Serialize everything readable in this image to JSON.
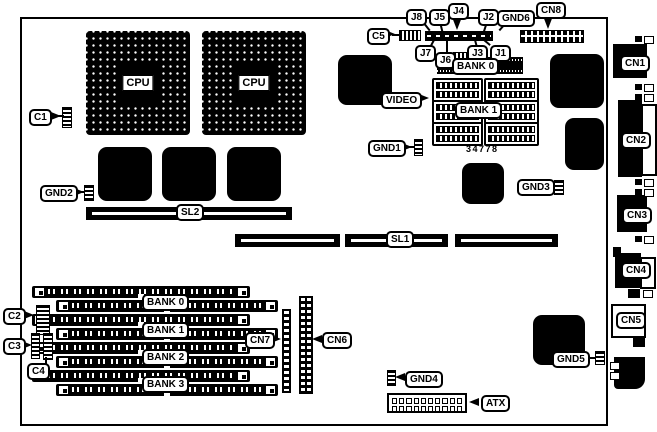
{
  "colors": {
    "ink": "#000000",
    "paper": "#ffffff"
  },
  "labels": {
    "c1": "C1",
    "c2": "C2",
    "c3": "C3",
    "c4": "C4",
    "c5": "C5",
    "j1": "J1",
    "j2": "J2",
    "j3": "J3",
    "j4": "J4",
    "j5": "J5",
    "j6": "J6",
    "j7": "J7",
    "j8": "J8",
    "gnd1": "GND1",
    "gnd2": "GND2",
    "gnd3": "GND3",
    "gnd4": "GND4",
    "gnd5": "GND5",
    "gnd6": "GND6",
    "cn1": "CN1",
    "cn2": "CN2",
    "cn3": "CN3",
    "cn4": "CN4",
    "cn5": "CN5",
    "cn6": "CN6",
    "cn7": "CN7",
    "cn8": "CN8",
    "sl1": "SL1",
    "sl2": "SL2",
    "atx": "ATX",
    "video": "VIDEO",
    "cpu": "CPU",
    "mem_bank0": "BANK 0",
    "mem_bank1": "BANK 1",
    "bank0": "BANK 0",
    "bank1": "BANK 1",
    "bank2": "BANK 2",
    "bank3": "BANK 3",
    "part_number": "34778"
  }
}
